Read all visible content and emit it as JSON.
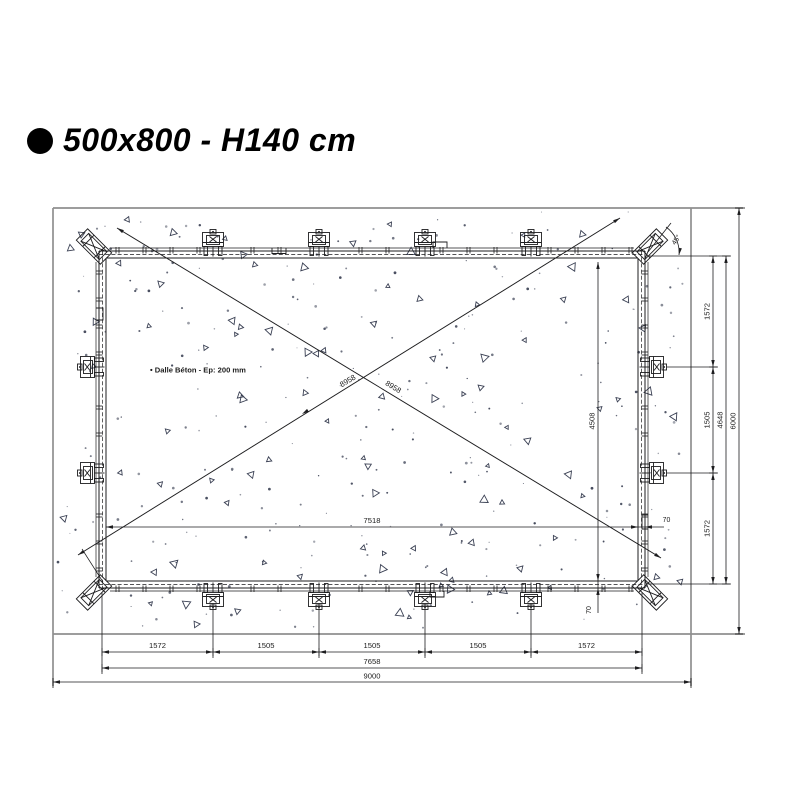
{
  "title": {
    "text": "500x800 - H140 cm"
  },
  "drawing": {
    "note": "• Dalle Béton - Ep: 200 mm",
    "dimensions": {
      "bottom_chain": [
        "1572",
        "1505",
        "1505",
        "1505",
        "1572"
      ],
      "bottom_subtotal": "7658",
      "bottom_total": "9000",
      "right_chain": [
        "1572",
        "1505",
        "1572"
      ],
      "right_subtotal": "4648",
      "right_total": "6000",
      "inner_width": "7518",
      "inner_height": "4508",
      "diagonal_left": "8958",
      "diagonal_right": "8958",
      "corner_angle": "45°",
      "wall_offset_right": "70",
      "wall_offset_bottom": "70"
    }
  },
  "colors": {
    "line": "#1d1d1f",
    "slab_edge": "#8f8f8f",
    "texture": "#3b4154"
  }
}
